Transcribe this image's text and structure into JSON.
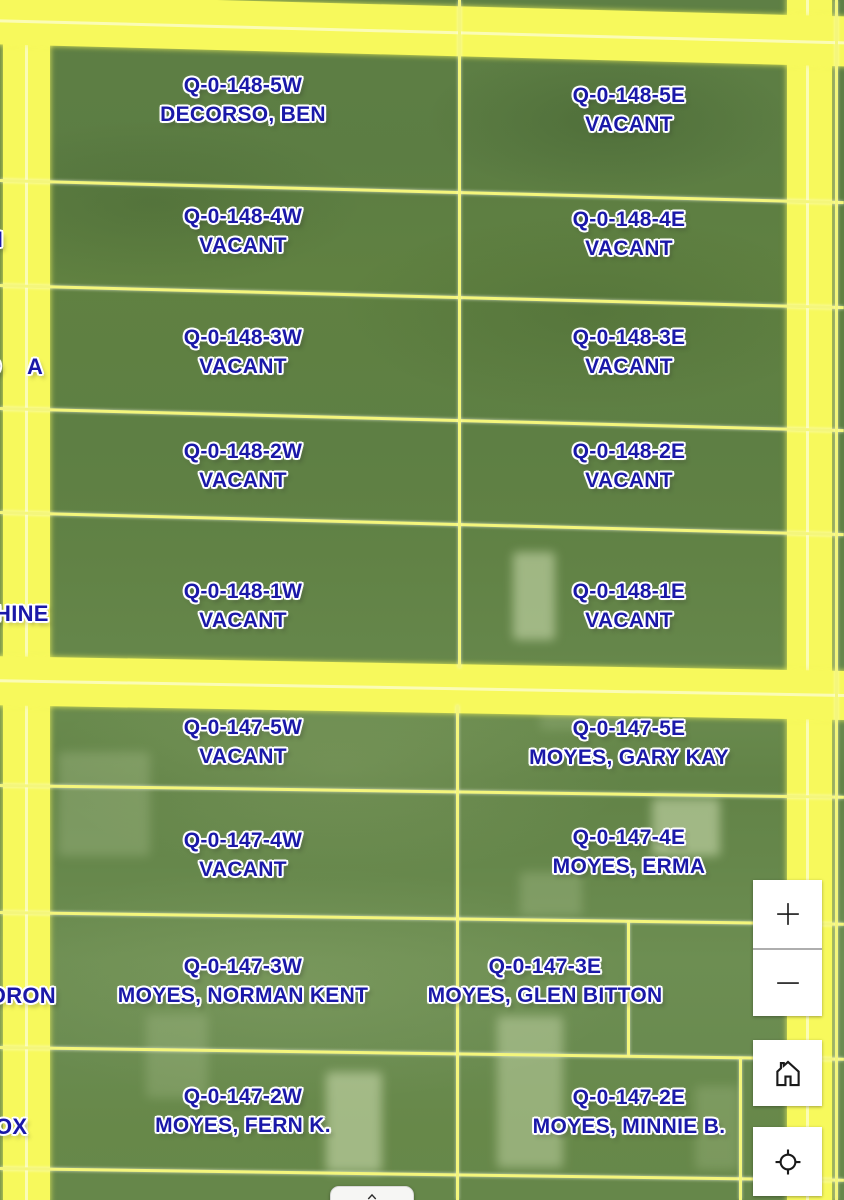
{
  "map": {
    "parcels": [
      {
        "id": "Q-0-148-5W",
        "owner": "DECORSO, BEN"
      },
      {
        "id": "Q-0-148-5E",
        "owner": "VACANT"
      },
      {
        "id": "Q-0-148-4W",
        "owner": "VACANT"
      },
      {
        "id": "Q-0-148-4E",
        "owner": "VACANT"
      },
      {
        "id": "Q-0-148-3W",
        "owner": "VACANT"
      },
      {
        "id": "Q-0-148-3E",
        "owner": "VACANT"
      },
      {
        "id": "Q-0-148-2W",
        "owner": "VACANT"
      },
      {
        "id": "Q-0-148-2E",
        "owner": "VACANT"
      },
      {
        "id": "Q-0-148-1W",
        "owner": "VACANT"
      },
      {
        "id": "Q-0-148-1E",
        "owner": "VACANT"
      },
      {
        "id": "Q-0-147-5W",
        "owner": "VACANT"
      },
      {
        "id": "Q-0-147-5E",
        "owner": "MOYES, GARY KAY"
      },
      {
        "id": "Q-0-147-4W",
        "owner": "VACANT"
      },
      {
        "id": "Q-0-147-4E",
        "owner": "MOYES, ERMA"
      },
      {
        "id": "Q-0-147-3W",
        "owner": "MOYES, NORMAN KENT"
      },
      {
        "id": "Q-0-147-3E",
        "owner": "MOYES, GLEN BITTON"
      },
      {
        "id": "Q-0-147-2W",
        "owner": "MOYES, FERN K."
      },
      {
        "id": "Q-0-147-2E",
        "owner": "MOYES, MINNIE B."
      }
    ],
    "edge_labels": [
      "N",
      "O",
      "A",
      "HINE",
      "DRON",
      "OX"
    ],
    "controls": {
      "zoom_in_icon": "plus-icon",
      "zoom_out_icon": "minus-icon",
      "home_icon": "home-icon",
      "locate_icon": "locate-icon",
      "attribution_icon": "chevron-up-icon"
    },
    "colors": {
      "label_blue": "#1a18a8",
      "label_halo": "#ffffff",
      "road_yellow": "#f7f95c",
      "boundary_yellow": "#f4f67c",
      "imagery_green": "#618145",
      "control_background": "#ffffff",
      "control_glyph": "#1a1a1a"
    }
  }
}
